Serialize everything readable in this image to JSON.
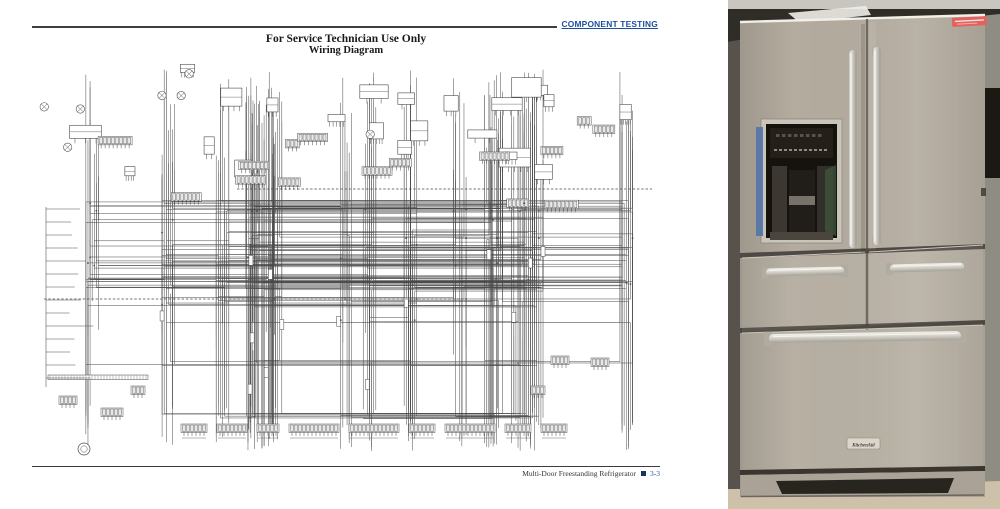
{
  "doc": {
    "header_label": "COMPONENT TESTING",
    "title_line1": "For Service Technician Use Only",
    "title_line2": "Wiring Diagram",
    "footer_text": "Multi-Door Freestanding Refrigerator",
    "footer_page": "3-3",
    "colors": {
      "header_blue": "#1b4f9e",
      "footer_blue": "#2a55a5",
      "rule_dark": "#3f3f3f",
      "square_navy": "#17355e"
    }
  },
  "diagram": {
    "seed": 88421,
    "wire_color": "#4a4a4a",
    "trunk_count": 17,
    "channel_count": 26,
    "wire_count": 235,
    "top_components": 30,
    "mid_combs": 15
  },
  "photo": {
    "badge_text": "KitchenAid",
    "colors": {
      "steel": "#b4ac9f",
      "steel_light": "#beb6a9",
      "handle_mount": "#b0aca2",
      "ceiling_light": "#c9c6c0",
      "ceiling_dark": "#2f2d28",
      "wall": "#8f8c84",
      "floor": "#cdc1aa",
      "left_shadow": "#57534c",
      "gap_dark": "#4e4a43",
      "dispenser_bezel": "#cac5ba",
      "dispenser_black": "#16130f",
      "display_dark": "#242019",
      "tape_blue": "#5677a8",
      "label_red": "#e2635e",
      "badge_bg": "#dbd6cb",
      "badge_text_color": "#45413a",
      "accent_green": "#41573f",
      "dark_object": "#1c1915",
      "base_recess": "#28251f"
    }
  }
}
